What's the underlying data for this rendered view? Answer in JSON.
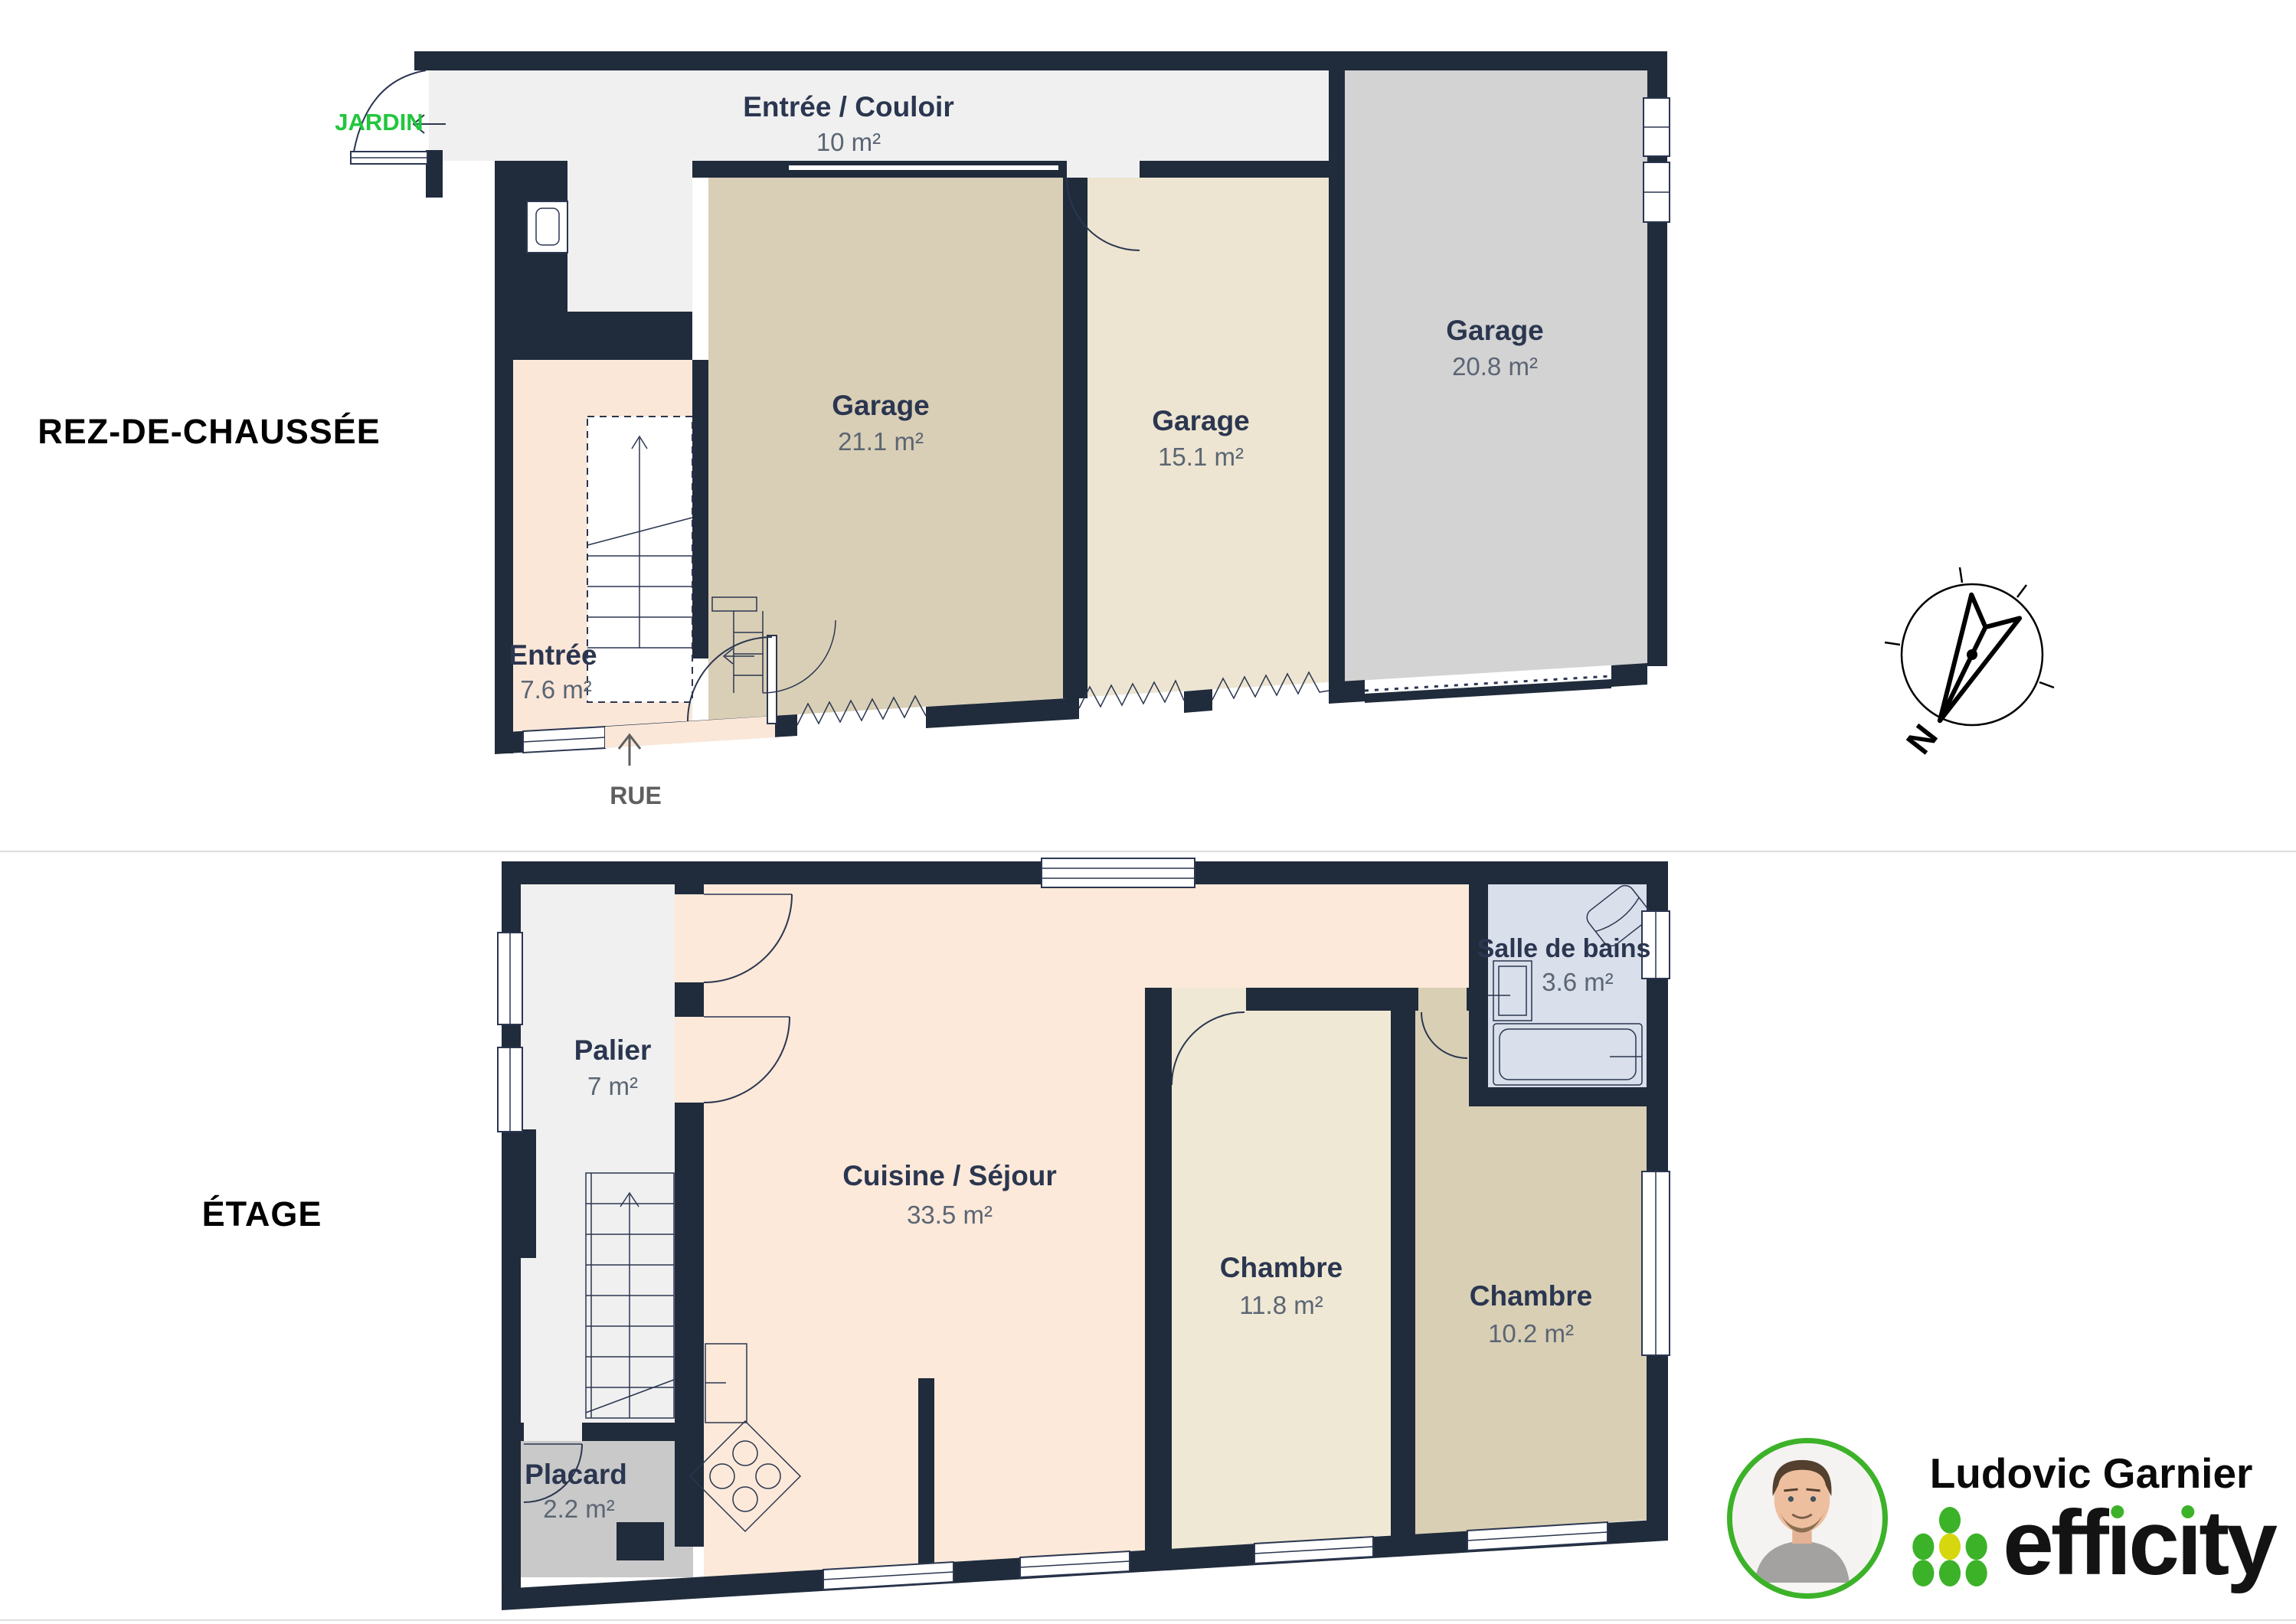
{
  "floors": [
    {
      "title": "REZ-DE-CHAUSSÉE",
      "rooms": [
        {
          "name": "Entrée / Couloir",
          "area": "10 m²"
        },
        {
          "name": "Garage",
          "area": "21.1 m²"
        },
        {
          "name": "Garage",
          "area": "15.1 m²"
        },
        {
          "name": "Garage",
          "area": "20.8 m²"
        },
        {
          "name": "Entrée",
          "area": "7.6 m²"
        }
      ],
      "annotations": {
        "garden": "JARDIN",
        "street": "RUE"
      }
    },
    {
      "title": "ÉTAGE",
      "rooms": [
        {
          "name": "Palier",
          "area": "7 m²"
        },
        {
          "name": "Cuisine / Séjour",
          "area": "33.5 m²"
        },
        {
          "name": "Chambre",
          "area": "11.8 m²"
        },
        {
          "name": "Chambre",
          "area": "10.2 m²"
        },
        {
          "name": "Salle de bains",
          "area": "3.6 m²"
        },
        {
          "name": "Placard",
          "area": "2.2 m²"
        }
      ]
    }
  ],
  "compass": {
    "north_label": "N"
  },
  "branding": {
    "agent_name": "Ludovic Garnier",
    "brand_name": "efficity"
  },
  "colors": {
    "wall_navy": "#202b3b",
    "corridor_gray": "#f0f0f0",
    "garage_tan": "#d9cfb6",
    "garage_beige": "#ede5d1",
    "garage_gray": "#d3d3d3",
    "entry_peach": "#fbe7d8",
    "landing_gray": "#f0f0f0",
    "kitchen_peach": "#fce9d9",
    "bedroom_beige": "#efe8d4",
    "bedroom_tan": "#d9cfb4",
    "bath_blue": "#d9dfeb",
    "closet_gray": "#c9c9c9",
    "garden_green": "#21c73c",
    "brand_green": "#3cb229",
    "brand_yellow": "#d6d70f"
  }
}
